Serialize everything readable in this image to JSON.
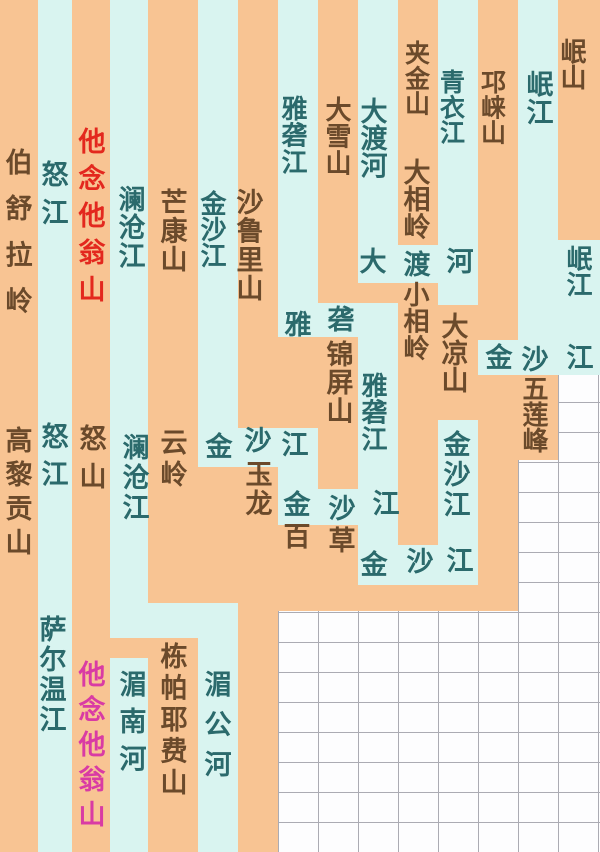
{
  "diagram": {
    "colors": {
      "mountain_stripe": "#f8c493",
      "river_stripe": "#d9f4f0",
      "river_text": "#2b6a6c",
      "mountain_text": "#6b4a2b",
      "highlight_red_text": "#e3281e",
      "highlight_pink_text": "#d93ba4",
      "grid_line": "#ababb3",
      "empty_cell": "#fdfdfe"
    },
    "grid": {
      "cell_width": 40,
      "cell_height": 30
    },
    "segments": [
      {
        "x": 0,
        "y": 0,
        "w": 38,
        "h": 852,
        "c": "orange"
      },
      {
        "x": 72,
        "y": 0,
        "w": 38,
        "h": 852,
        "c": "orange"
      },
      {
        "x": 148,
        "y": 0,
        "w": 50,
        "h": 603,
        "c": "orange"
      },
      {
        "x": 148,
        "y": 638,
        "w": 50,
        "h": 214,
        "c": "orange"
      },
      {
        "x": 110,
        "y": 638,
        "w": 38,
        "h": 22,
        "c": "orange"
      },
      {
        "x": 198,
        "y": 467,
        "w": 40,
        "h": 136,
        "c": "orange"
      },
      {
        "x": 238,
        "y": 0,
        "w": 40,
        "h": 428,
        "c": "orange"
      },
      {
        "x": 238,
        "y": 467,
        "w": 40,
        "h": 385,
        "c": "orange"
      },
      {
        "x": 278,
        "y": 337,
        "w": 40,
        "h": 91,
        "c": "orange"
      },
      {
        "x": 278,
        "y": 525,
        "w": 40,
        "h": 86,
        "c": "orange"
      },
      {
        "x": 318,
        "y": 0,
        "w": 40,
        "h": 303,
        "c": "orange"
      },
      {
        "x": 318,
        "y": 337,
        "w": 40,
        "h": 152,
        "c": "orange"
      },
      {
        "x": 318,
        "y": 525,
        "w": 40,
        "h": 86,
        "c": "orange"
      },
      {
        "x": 358,
        "y": 280,
        "w": 40,
        "h": 23,
        "c": "orange"
      },
      {
        "x": 358,
        "y": 585,
        "w": 160,
        "h": 26,
        "c": "orange"
      },
      {
        "x": 398,
        "y": 0,
        "w": 40,
        "h": 245,
        "c": "orange"
      },
      {
        "x": 398,
        "y": 283,
        "w": 40,
        "h": 262,
        "c": "orange"
      },
      {
        "x": 438,
        "y": 305,
        "w": 40,
        "h": 115,
        "c": "orange"
      },
      {
        "x": 478,
        "y": 0,
        "w": 40,
        "h": 340,
        "c": "orange"
      },
      {
        "x": 478,
        "y": 375,
        "w": 40,
        "h": 236,
        "c": "orange"
      },
      {
        "x": 518,
        "y": 372,
        "w": 40,
        "h": 88,
        "c": "orange"
      },
      {
        "x": 558,
        "y": 0,
        "w": 42,
        "h": 240,
        "c": "orange"
      },
      {
        "x": 38,
        "y": 0,
        "w": 34,
        "h": 852,
        "c": "cyan"
      },
      {
        "x": 110,
        "y": 0,
        "w": 38,
        "h": 638,
        "c": "cyan"
      },
      {
        "x": 110,
        "y": 658,
        "w": 38,
        "h": 194,
        "c": "cyan"
      },
      {
        "x": 198,
        "y": 0,
        "w": 40,
        "h": 467,
        "c": "cyan"
      },
      {
        "x": 110,
        "y": 603,
        "w": 128,
        "h": 35,
        "c": "cyan"
      },
      {
        "x": 198,
        "y": 638,
        "w": 40,
        "h": 214,
        "c": "cyan"
      },
      {
        "x": 198,
        "y": 428,
        "w": 120,
        "h": 39,
        "c": "cyan"
      },
      {
        "x": 278,
        "y": 0,
        "w": 40,
        "h": 337,
        "c": "cyan"
      },
      {
        "x": 278,
        "y": 303,
        "w": 120,
        "h": 34,
        "c": "cyan"
      },
      {
        "x": 278,
        "y": 428,
        "w": 40,
        "h": 97,
        "c": "cyan"
      },
      {
        "x": 278,
        "y": 489,
        "w": 120,
        "h": 36,
        "c": "cyan"
      },
      {
        "x": 358,
        "y": 0,
        "w": 40,
        "h": 280,
        "c": "cyan"
      },
      {
        "x": 358,
        "y": 303,
        "w": 40,
        "h": 282,
        "c": "cyan"
      },
      {
        "x": 358,
        "y": 245,
        "w": 120,
        "h": 38,
        "c": "cyan"
      },
      {
        "x": 358,
        "y": 545,
        "w": 120,
        "h": 40,
        "c": "cyan"
      },
      {
        "x": 438,
        "y": 0,
        "w": 40,
        "h": 305,
        "c": "cyan"
      },
      {
        "x": 438,
        "y": 420,
        "w": 40,
        "h": 165,
        "c": "cyan"
      },
      {
        "x": 478,
        "y": 340,
        "w": 122,
        "h": 35,
        "c": "cyan"
      },
      {
        "x": 518,
        "y": 0,
        "w": 40,
        "h": 372,
        "c": "cyan"
      },
      {
        "x": 558,
        "y": 240,
        "w": 42,
        "h": 135,
        "c": "cyan"
      }
    ],
    "labels": [
      {
        "t": "伯舒拉岭",
        "x": 17,
        "y": 148,
        "h": 185,
        "c": "m"
      },
      {
        "t": "怒江",
        "x": 53,
        "y": 160,
        "h": 76,
        "c": "r"
      },
      {
        "t": "他念他翁山",
        "x": 90,
        "y": 127,
        "h": 185,
        "c": "red"
      },
      {
        "t": "澜沧江",
        "x": 130,
        "y": 185,
        "h": 85,
        "c": "r"
      },
      {
        "t": "芒康山",
        "x": 172,
        "y": 188,
        "h": 86,
        "c": "m"
      },
      {
        "t": "金沙江",
        "x": 212,
        "y": 190,
        "h": 78,
        "c": "r"
      },
      {
        "t": "沙鲁里山",
        "x": 248,
        "y": 188,
        "h": 115,
        "c": "m"
      },
      {
        "t": "雅砻江",
        "x": 293,
        "y": 95,
        "h": 80,
        "c": "r"
      },
      {
        "t": "大雪山",
        "x": 337,
        "y": 96,
        "h": 80,
        "c": "m"
      },
      {
        "t": "大渡河",
        "x": 372,
        "y": 97,
        "h": 82,
        "c": "r"
      },
      {
        "t": "夹金山",
        "x": 417,
        "y": 40,
        "h": 76,
        "c": "m"
      },
      {
        "t": "青衣江",
        "x": 452,
        "y": 69,
        "h": 76,
        "c": "r"
      },
      {
        "t": "邛崃山",
        "x": 493,
        "y": 69,
        "h": 76,
        "c": "m"
      },
      {
        "t": "岷江",
        "x": 538,
        "y": 70,
        "h": 56,
        "c": "r"
      },
      {
        "t": "岷山",
        "x": 572,
        "y": 38,
        "h": 52,
        "c": "m"
      },
      {
        "t": "大相岭",
        "x": 415,
        "y": 158,
        "h": 82,
        "c": "m"
      },
      {
        "t": "大",
        "x": 371,
        "y": 247,
        "h": 27,
        "c": "r"
      },
      {
        "t": "渡",
        "x": 415,
        "y": 250,
        "h": 27,
        "c": "r"
      },
      {
        "t": "河",
        "x": 458,
        "y": 247,
        "h": 27,
        "c": "r"
      },
      {
        "t": "岷江",
        "x": 578,
        "y": 245,
        "h": 52,
        "c": "r"
      },
      {
        "t": "小相岭",
        "x": 415,
        "y": 281,
        "h": 80,
        "c": "m"
      },
      {
        "t": "大凉山",
        "x": 453,
        "y": 312,
        "h": 81,
        "c": "m"
      },
      {
        "t": "雅",
        "x": 296,
        "y": 310,
        "h": 27,
        "c": "r"
      },
      {
        "t": "砻",
        "x": 339,
        "y": 305,
        "h": 27,
        "c": "r"
      },
      {
        "t": "锦屏山",
        "x": 338,
        "y": 340,
        "h": 85,
        "c": "m"
      },
      {
        "t": "雅砻江",
        "x": 373,
        "y": 372,
        "h": 80,
        "c": "r"
      },
      {
        "t": "金",
        "x": 497,
        "y": 343,
        "h": 27,
        "c": "r"
      },
      {
        "t": "沙",
        "x": 533,
        "y": 345,
        "h": 27,
        "c": "r"
      },
      {
        "t": "江",
        "x": 578,
        "y": 343,
        "h": 27,
        "c": "r"
      },
      {
        "t": "五莲峰",
        "x": 534,
        "y": 375,
        "h": 78,
        "c": "m"
      },
      {
        "t": "高黎贡山",
        "x": 17,
        "y": 426,
        "h": 136,
        "c": "m"
      },
      {
        "t": "怒江",
        "x": 53,
        "y": 422,
        "h": 75,
        "c": "r"
      },
      {
        "t": "怒山",
        "x": 91,
        "y": 424,
        "h": 76,
        "c": "m"
      },
      {
        "t": "澜沧江",
        "x": 134,
        "y": 433,
        "h": 90,
        "c": "r"
      },
      {
        "t": "云岭",
        "x": 172,
        "y": 428,
        "h": 64,
        "c": "m"
      },
      {
        "t": "金",
        "x": 217,
        "y": 432,
        "h": 27,
        "c": "r"
      },
      {
        "t": "沙",
        "x": 256,
        "y": 426,
        "h": 27,
        "c": "r"
      },
      {
        "t": "江",
        "x": 293,
        "y": 430,
        "h": 27,
        "c": "r"
      },
      {
        "t": "玉龙",
        "x": 257,
        "y": 460,
        "h": 58,
        "c": "m"
      },
      {
        "t": "金沙江",
        "x": 455,
        "y": 430,
        "h": 90,
        "c": "r"
      },
      {
        "t": "金",
        "x": 295,
        "y": 490,
        "h": 27,
        "c": "r"
      },
      {
        "t": "沙",
        "x": 340,
        "y": 494,
        "h": 27,
        "c": "r"
      },
      {
        "t": "江",
        "x": 384,
        "y": 489,
        "h": 27,
        "c": "r"
      },
      {
        "t": "百",
        "x": 295,
        "y": 522,
        "h": 27,
        "c": "m"
      },
      {
        "t": "草",
        "x": 340,
        "y": 526,
        "h": 27,
        "c": "m"
      },
      {
        "t": "金",
        "x": 372,
        "y": 550,
        "h": 27,
        "c": "r"
      },
      {
        "t": "沙",
        "x": 418,
        "y": 547,
        "h": 27,
        "c": "r"
      },
      {
        "t": "江",
        "x": 458,
        "y": 546,
        "h": 27,
        "c": "r"
      },
      {
        "t": "萨尔温江",
        "x": 51,
        "y": 615,
        "h": 120,
        "c": "r"
      },
      {
        "t": "他念他翁山",
        "x": 90,
        "y": 660,
        "h": 175,
        "c": "pink"
      },
      {
        "t": "湄南河",
        "x": 131,
        "y": 670,
        "h": 112,
        "c": "r"
      },
      {
        "t": "栋帕耶费山",
        "x": 172,
        "y": 642,
        "h": 158,
        "c": "m"
      },
      {
        "t": "湄公河",
        "x": 216,
        "y": 670,
        "h": 120,
        "c": "r"
      }
    ]
  }
}
